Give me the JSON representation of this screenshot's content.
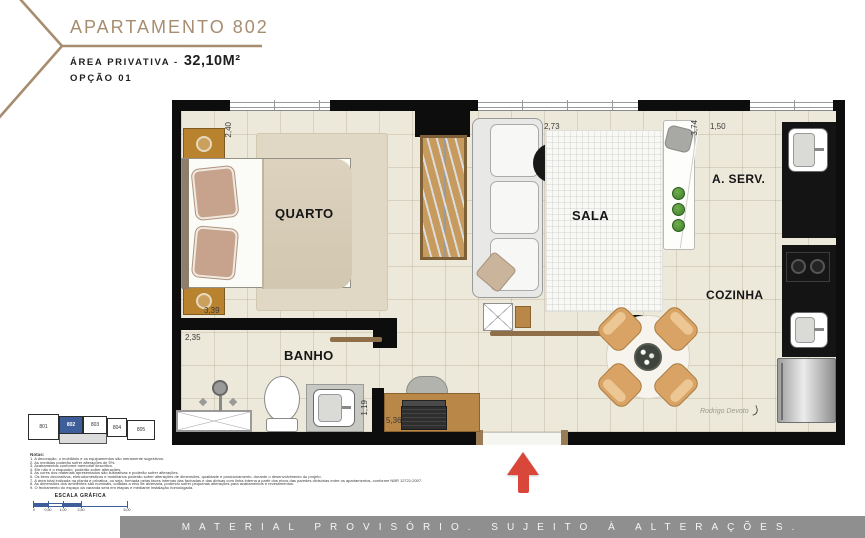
{
  "header": {
    "title": "APARTAMENTO 802",
    "area_label": "ÁREA PRIVATIVA -",
    "area_value": "32,10M²",
    "option": "OPÇÃO 01"
  },
  "plan": {
    "rooms": {
      "quarto": "QUARTO",
      "sala": "SALA",
      "aserv": "A. SERV.",
      "cozinha": "COZINHA",
      "banho": "BANHO"
    },
    "dims": {
      "quarto_h": "2,40",
      "quarto_w": "3,39",
      "sala_w": "2,73",
      "sala_h": "3,74",
      "aserv_w": "1,50",
      "banho_w": "2,35",
      "hall_h": "1,19",
      "desk_w": "5,36"
    },
    "signature": "Rodrigo Devoto"
  },
  "keyplan": {
    "units": [
      {
        "label": "801",
        "active": false
      },
      {
        "label": "802",
        "active": true
      },
      {
        "label": "803",
        "active": false
      },
      {
        "label": "804",
        "active": false
      },
      {
        "label": "805",
        "active": false
      }
    ]
  },
  "notes": {
    "title": "Notas:",
    "lines": [
      "1. A decoração, o mobiliário e os equipamentos são meramente sugestivos.",
      "2. As medidas poderão sofrer alterações de 5%.",
      "3. Acabamentos conforme memorial descritivo.",
      "4. Ele não é o esquadro, poderão sofrer alterações.",
      "5. As cores dos materiais apresentados são ilustrativas e poderão sofrer alterações.",
      "6. Os itens decorativos, eletrodomésticos e mobiliários poderão sofrer alterações de dimensões, qualidade e posicionamento, durante o desenvolvimento do projeto.",
      "7. A área total indicada na planta é privativa, ou seja, formada pelas faces internas das fachadas e das divisas com linha interna a partir dos eixos das paredes divisórias entre os apartamentos, conforme NBR 12721:2007.",
      "8. As dimensões dos ambientes são nominais, cotadas a eixo de alvenaria, podendo sofrer pequenas alterações para acabamentos e revestimentos.",
      "9. O fechamento do espaço da varanda será em etapas e mediante instalação homologada."
    ]
  },
  "scale": {
    "label": "ESCALA GRÁFICA",
    "ticks": [
      "0",
      "0,50",
      "1,00",
      "2,50",
      "5,00"
    ]
  },
  "footer": {
    "text": "MATERIAL PROVISÓRIO. SUJEITO À ALTERAÇÕES."
  },
  "colors": {
    "accent": "#A78D6F",
    "wall": "#0D0D0D",
    "floor": "#EDE9DA",
    "highlight": "#3D5E99",
    "arrow": "#D9473B",
    "footer_bg": "#8F8F8F",
    "wood": "#B98748"
  }
}
